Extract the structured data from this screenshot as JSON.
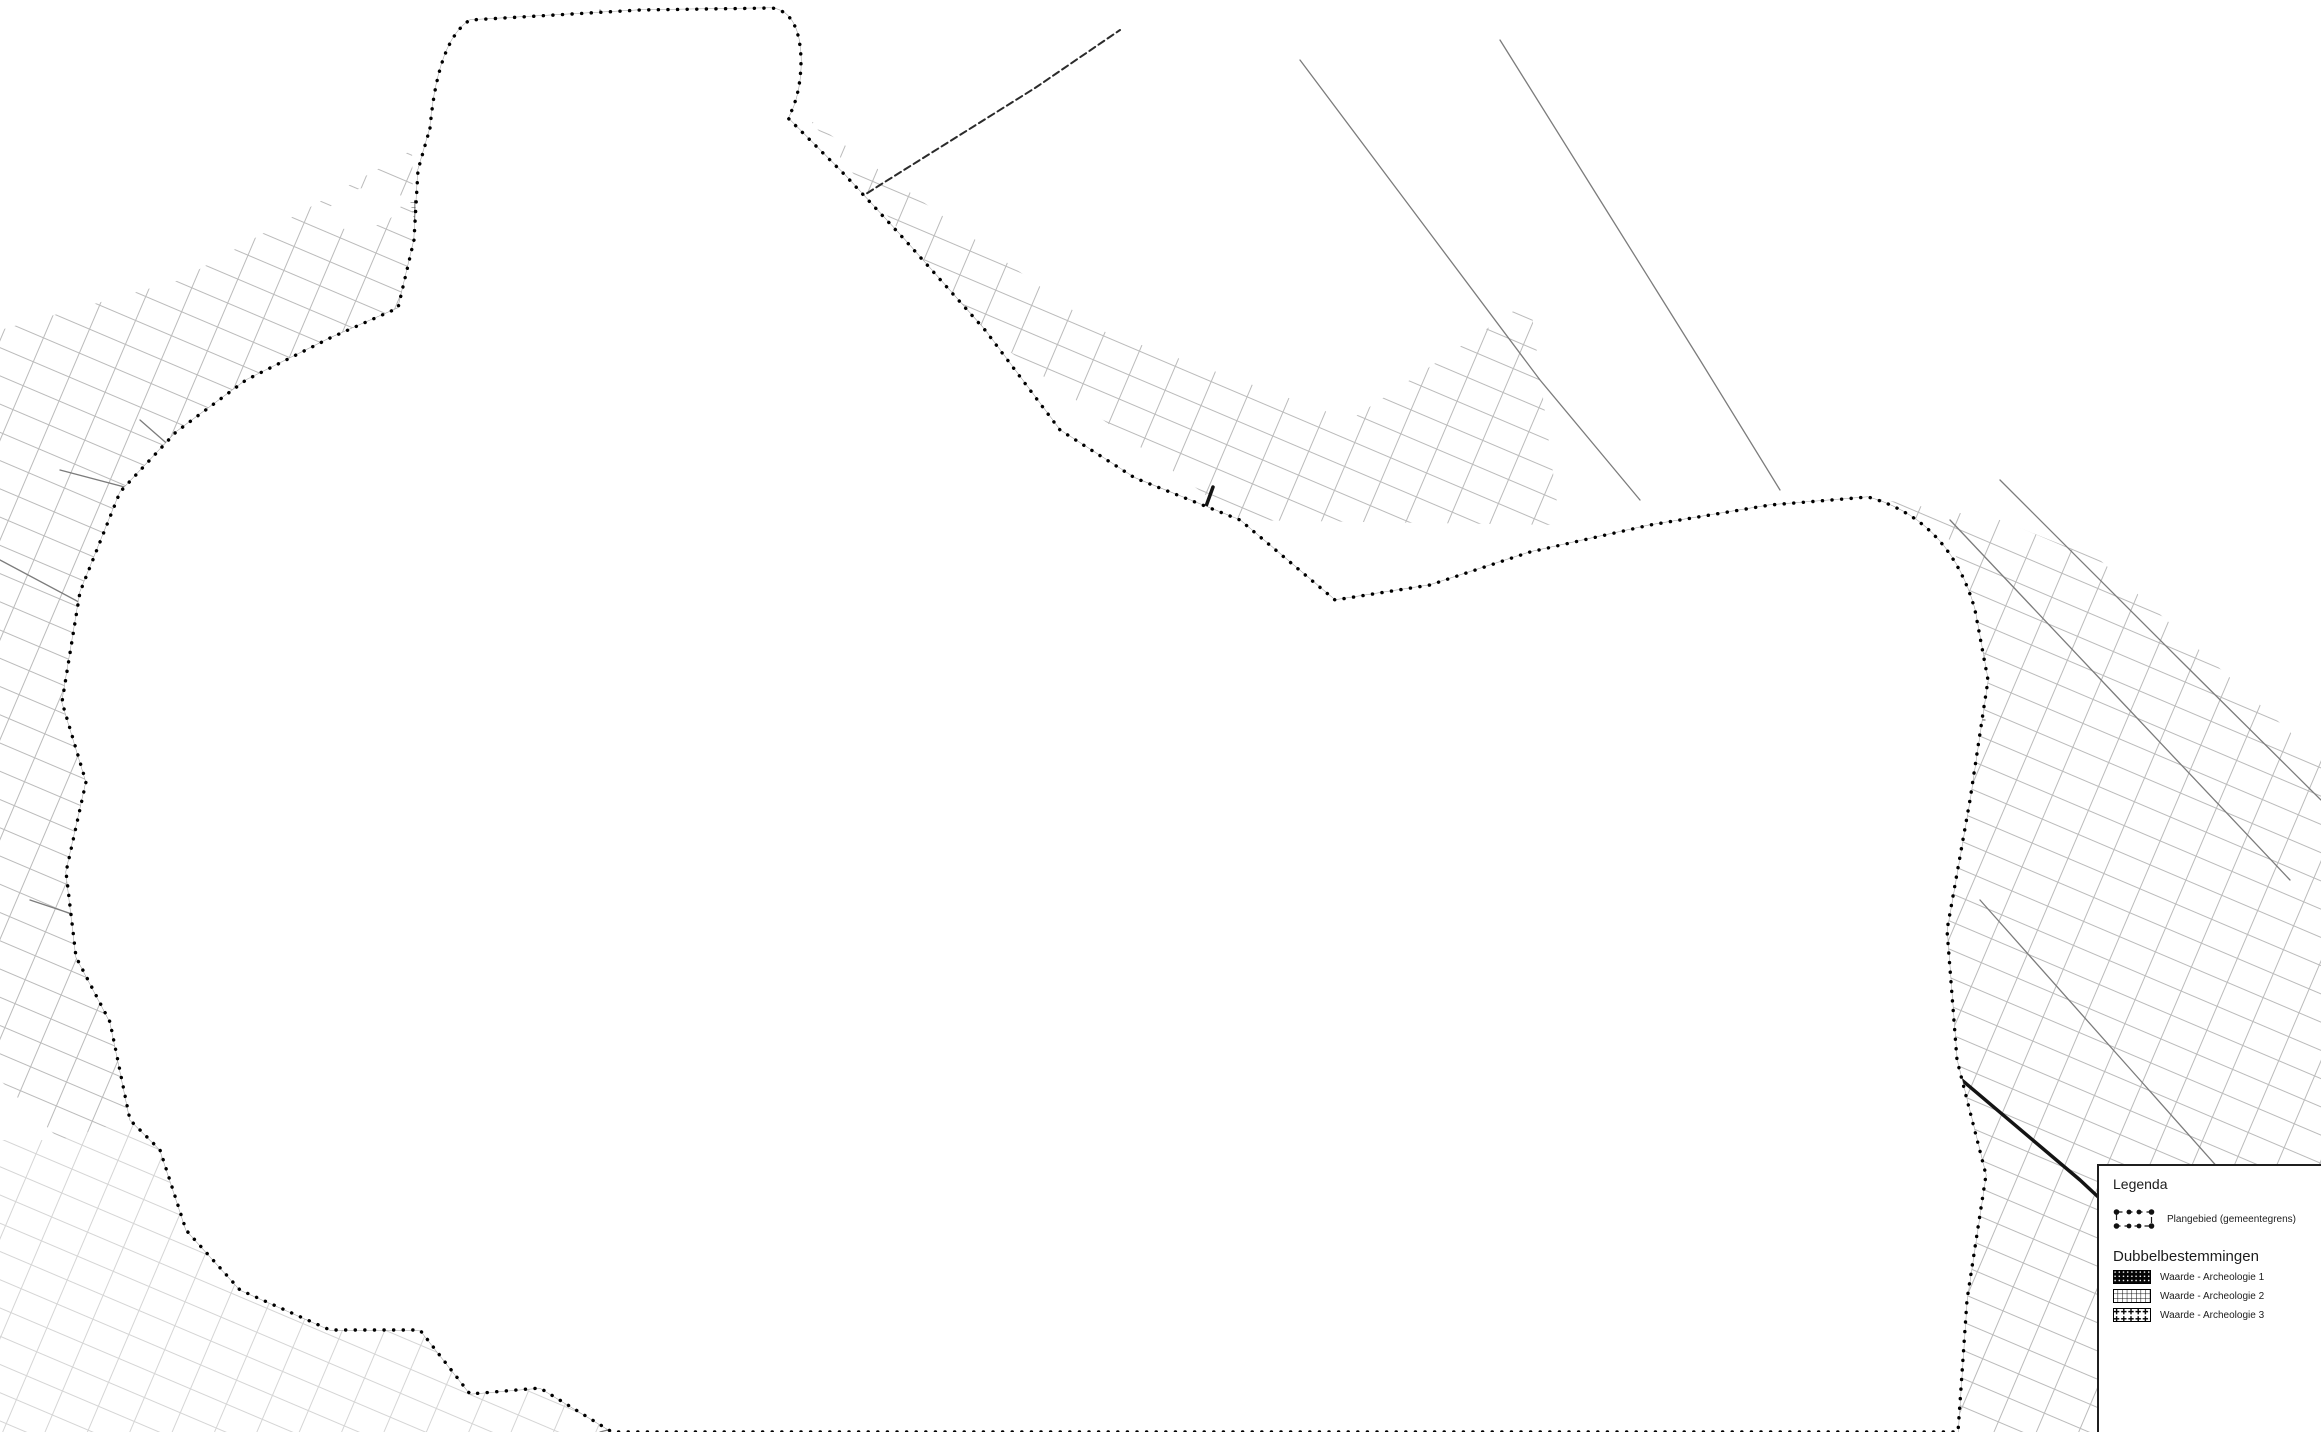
{
  "legend": {
    "title": "Legenda",
    "plangebied": {
      "label": "Plangebied (gemeentegrens)",
      "symbol": "dash-dot-boundary-rectangle"
    },
    "section": "Dubbelbestemmingen",
    "items": [
      {
        "label": "Waarde - Archeologie 1",
        "swatch": "solid-black-with-white-dots"
      },
      {
        "label": "Waarde - Archeologie 2",
        "swatch": "dense-grid-hatch"
      },
      {
        "label": "Waarde - Archeologie 3",
        "swatch": "plus-cross-dot-hatch"
      }
    ]
  },
  "map": {
    "colors": {
      "paper": "#ffffff",
      "ink": "#0a0a0a",
      "road_gray": "#7c7c7c",
      "parcel_gray": "#b3b3b3"
    }
  }
}
